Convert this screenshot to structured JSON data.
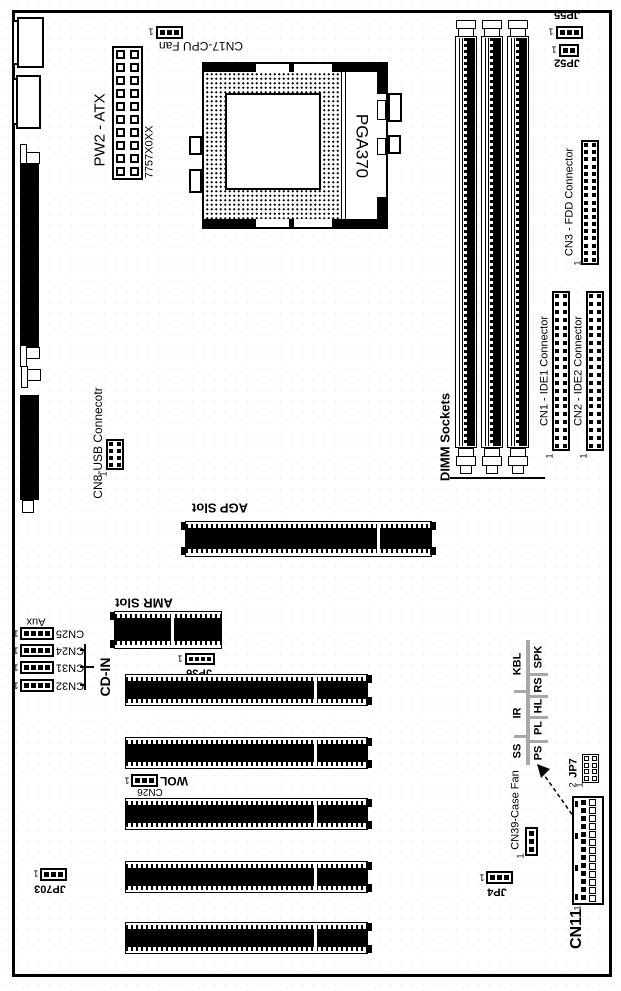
{
  "labels": {
    "pw2_atx": "PW2 - ATX",
    "atx_code": "7757X0XX",
    "cpu_fan": "CN17-CPU Fan",
    "socket": "PGA370",
    "jp55": "JP55",
    "jp52": "JP52",
    "fdd": "CN3 - FDD Connector",
    "dimm": "DIMM Sockets",
    "ide1": "CN1 - IDE1 Connector",
    "ide2": "CN2 - IDE2 Connector",
    "usb": "CN8-USB Connecotr",
    "agp": "AGP Slot",
    "amr": "AMR Slot",
    "jp36": "JP36",
    "aux": "Aux",
    "cn25": "CN25",
    "cn24": "CN24",
    "cn31": "CN31",
    "cn32": "CN32",
    "cdin": "CD-IN",
    "wol": "WOL",
    "cn26": "CN26",
    "jp703": "JP703",
    "cn39": "CN39-Case Fan",
    "jp4": "JP4",
    "jp7": "JP7",
    "cn11": "CN11",
    "pin1": "1",
    "pin2": "2"
  },
  "panel_table": {
    "row1": [
      "SS",
      "IR",
      "KBL"
    ],
    "row2": [
      "PS",
      "PL",
      "HL",
      "RS",
      "SPK"
    ]
  }
}
